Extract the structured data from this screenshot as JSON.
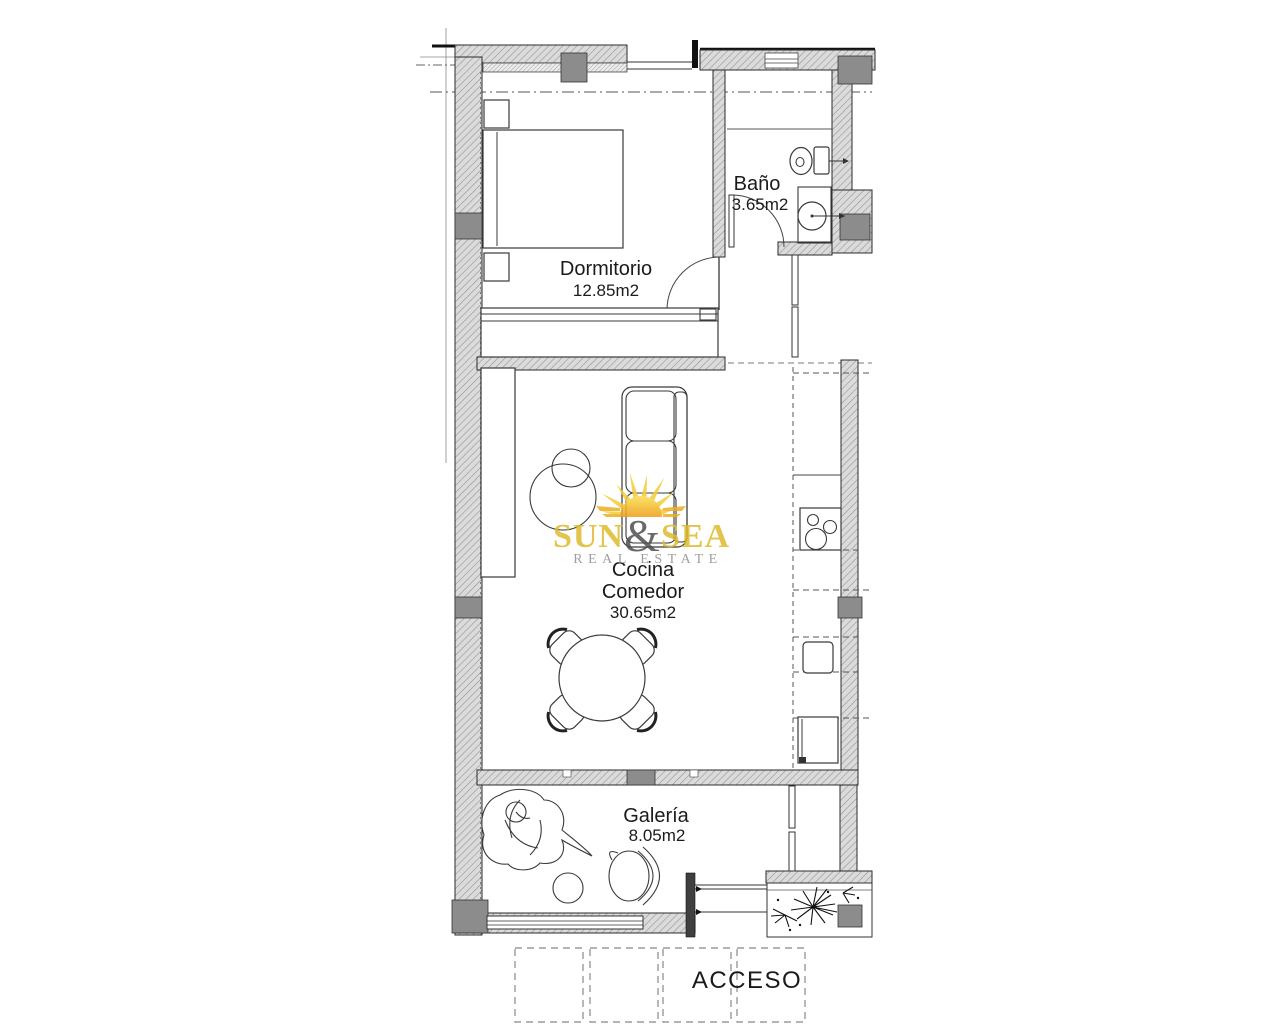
{
  "page": {
    "background": "#FFFFFF"
  },
  "plan": {
    "access_label": "ACCESO",
    "rooms": {
      "dormitorio": {
        "name": "Dormitorio",
        "area": "12.85m2"
      },
      "bano": {
        "name": "Baño",
        "area": "3.65m2"
      },
      "cocina_comedor": {
        "name_line1": "Cocina",
        "name_line2": "Comedor",
        "area": "30.65m2"
      },
      "galeria": {
        "name": "Galería",
        "area": "8.05m2"
      }
    }
  },
  "logo": {
    "word1": "SUN",
    "ampersand": "&",
    "word2": "SEA",
    "subtitle": "REAL ESTATE",
    "colors": {
      "gold": "#DFBA2D",
      "ampersand_gray": "#4F4F4F",
      "subtitle_gray": "#8F8F8F",
      "sun_yellow": "#F3CD39",
      "sun_orange": "#EC9E1A"
    }
  },
  "colors": {
    "wall_fill": "#DBDBDB",
    "wall_hatch": "#9A9A9A",
    "wall_dark_fill": "#8C8C8C",
    "line_dark": "#1F1F1F"
  }
}
